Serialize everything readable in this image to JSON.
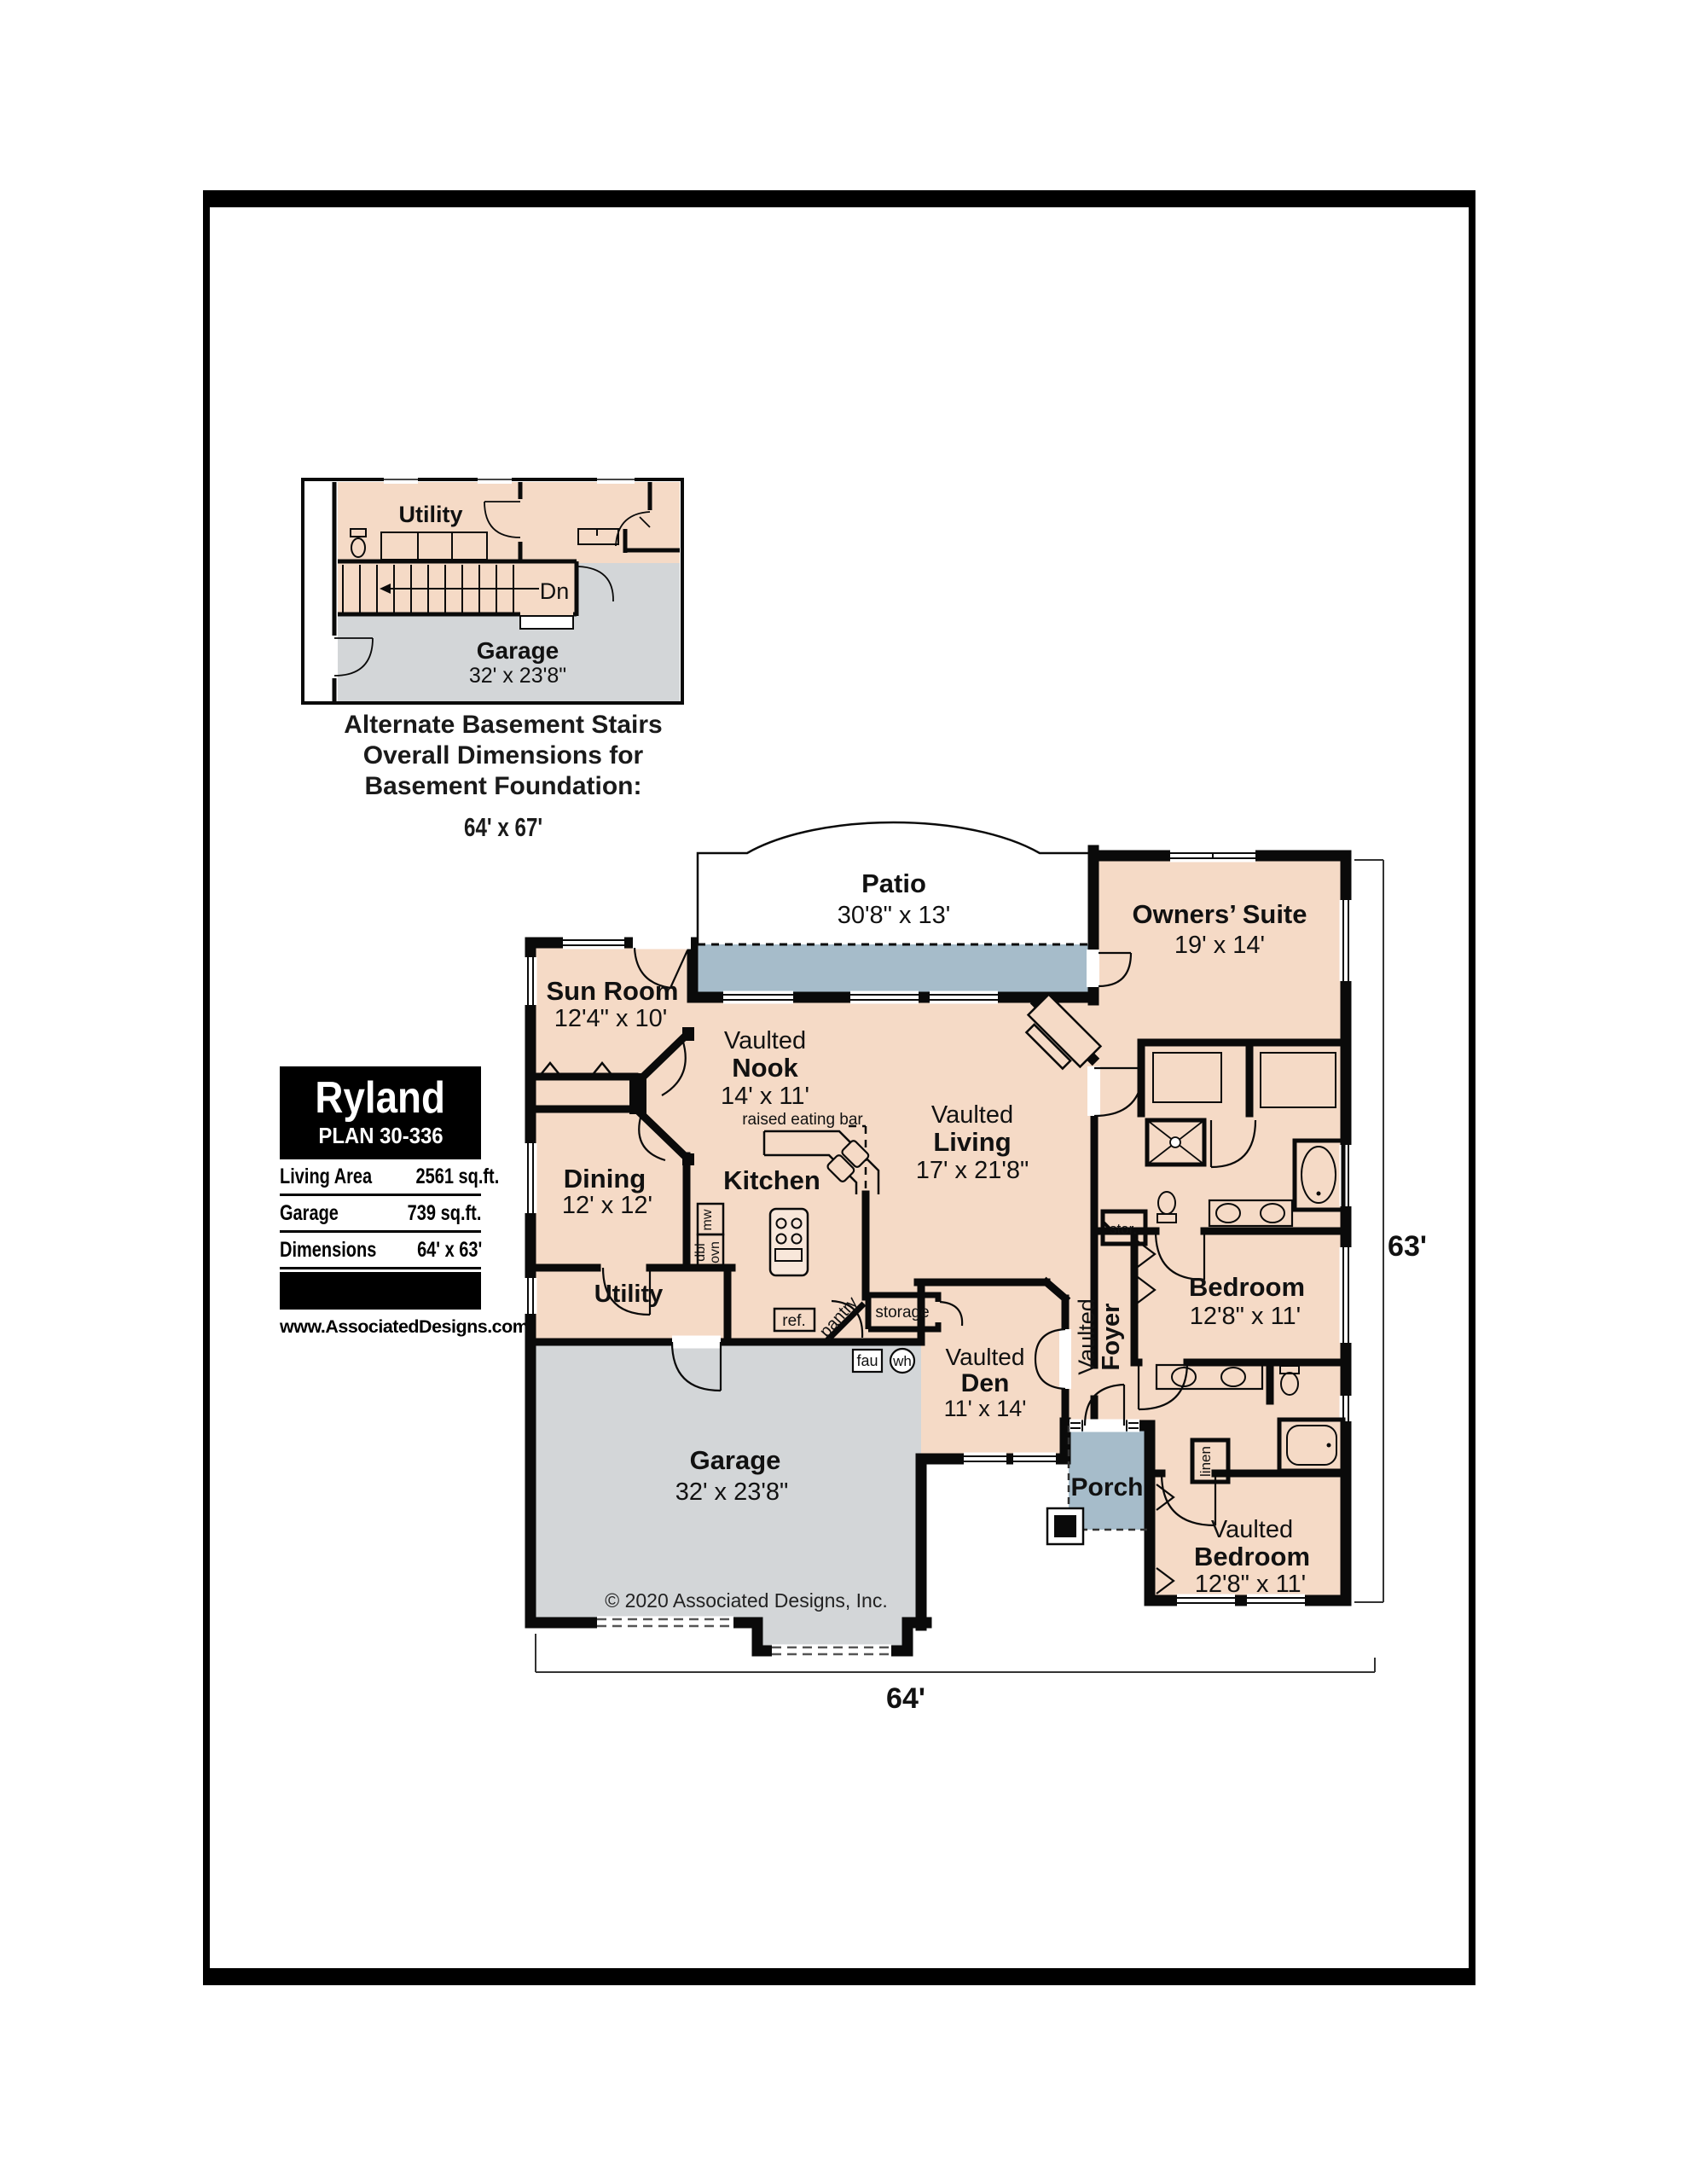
{
  "colors": {
    "floor_peach": "#f5dac6",
    "patio_porch_blue": "#a6bcca",
    "garage_gray": "#d3d6d8",
    "wall_black": "#0a0a0a"
  },
  "title_block": {
    "plan_name": "Ryland",
    "plan_number": "PLAN 30-336",
    "rows": [
      {
        "label": "Living Area",
        "value": "2561 sq.ft."
      },
      {
        "label": "Garage",
        "value": "739 sq.ft."
      },
      {
        "label": "Dimensions",
        "value": "64' x 63'"
      }
    ],
    "website": "www.AssociatedDesigns.com"
  },
  "inset": {
    "utility_label": "Utility",
    "stairs_label": "Dn",
    "garage_label": "Garage",
    "garage_dims": "32' x 23'8\"",
    "caption_line1": "Alternate Basement Stairs",
    "caption_line2": "Overall Dimensions for",
    "caption_line3": "Basement Foundation:",
    "caption_dims": "64' x 67'"
  },
  "plan": {
    "rooms": {
      "patio": {
        "name": "Patio",
        "dims": "30'8\" x 13'"
      },
      "owners": {
        "name": "Owners’ Suite",
        "dims": "19' x 14'"
      },
      "sun": {
        "name": "Sun Room",
        "dims": "12'4\" x 10'"
      },
      "nook": {
        "prefix": "Vaulted",
        "name": "Nook",
        "dims": "14' x 11'"
      },
      "living": {
        "prefix": "Vaulted",
        "name": "Living",
        "dims": "17' x 21'8\""
      },
      "dining": {
        "name": "Dining",
        "dims": "12' x 12'"
      },
      "kitchen": {
        "name": "Kitchen"
      },
      "utility": {
        "name": "Utility"
      },
      "den": {
        "prefix": "Vaulted",
        "name": "Den",
        "dims": "11' x 14'"
      },
      "foyer": {
        "prefix": "Vaulted",
        "name": "Foyer"
      },
      "bedroom1": {
        "name": "Bedroom",
        "dims": "12'8\" x 11'"
      },
      "porch": {
        "name": "Porch"
      },
      "bedroom2": {
        "prefix": "Vaulted",
        "name": "Bedroom",
        "dims": "12'8\" x 11'"
      },
      "garage": {
        "name": "Garage",
        "dims": "32' x 23'8\""
      }
    },
    "labels": {
      "eating_bar": "raised eating bar",
      "pantry": "pantry",
      "ref": "ref.",
      "mw": "mw",
      "dbl": "dbl",
      "ovn": "ovn",
      "storage": "storage",
      "stor": "stor.",
      "fau": "fau",
      "wh": "wh",
      "linen": "linen"
    },
    "dims": {
      "width": "64'",
      "height": "63'"
    },
    "copyright": "© 2020 Associated Designs, Inc."
  }
}
